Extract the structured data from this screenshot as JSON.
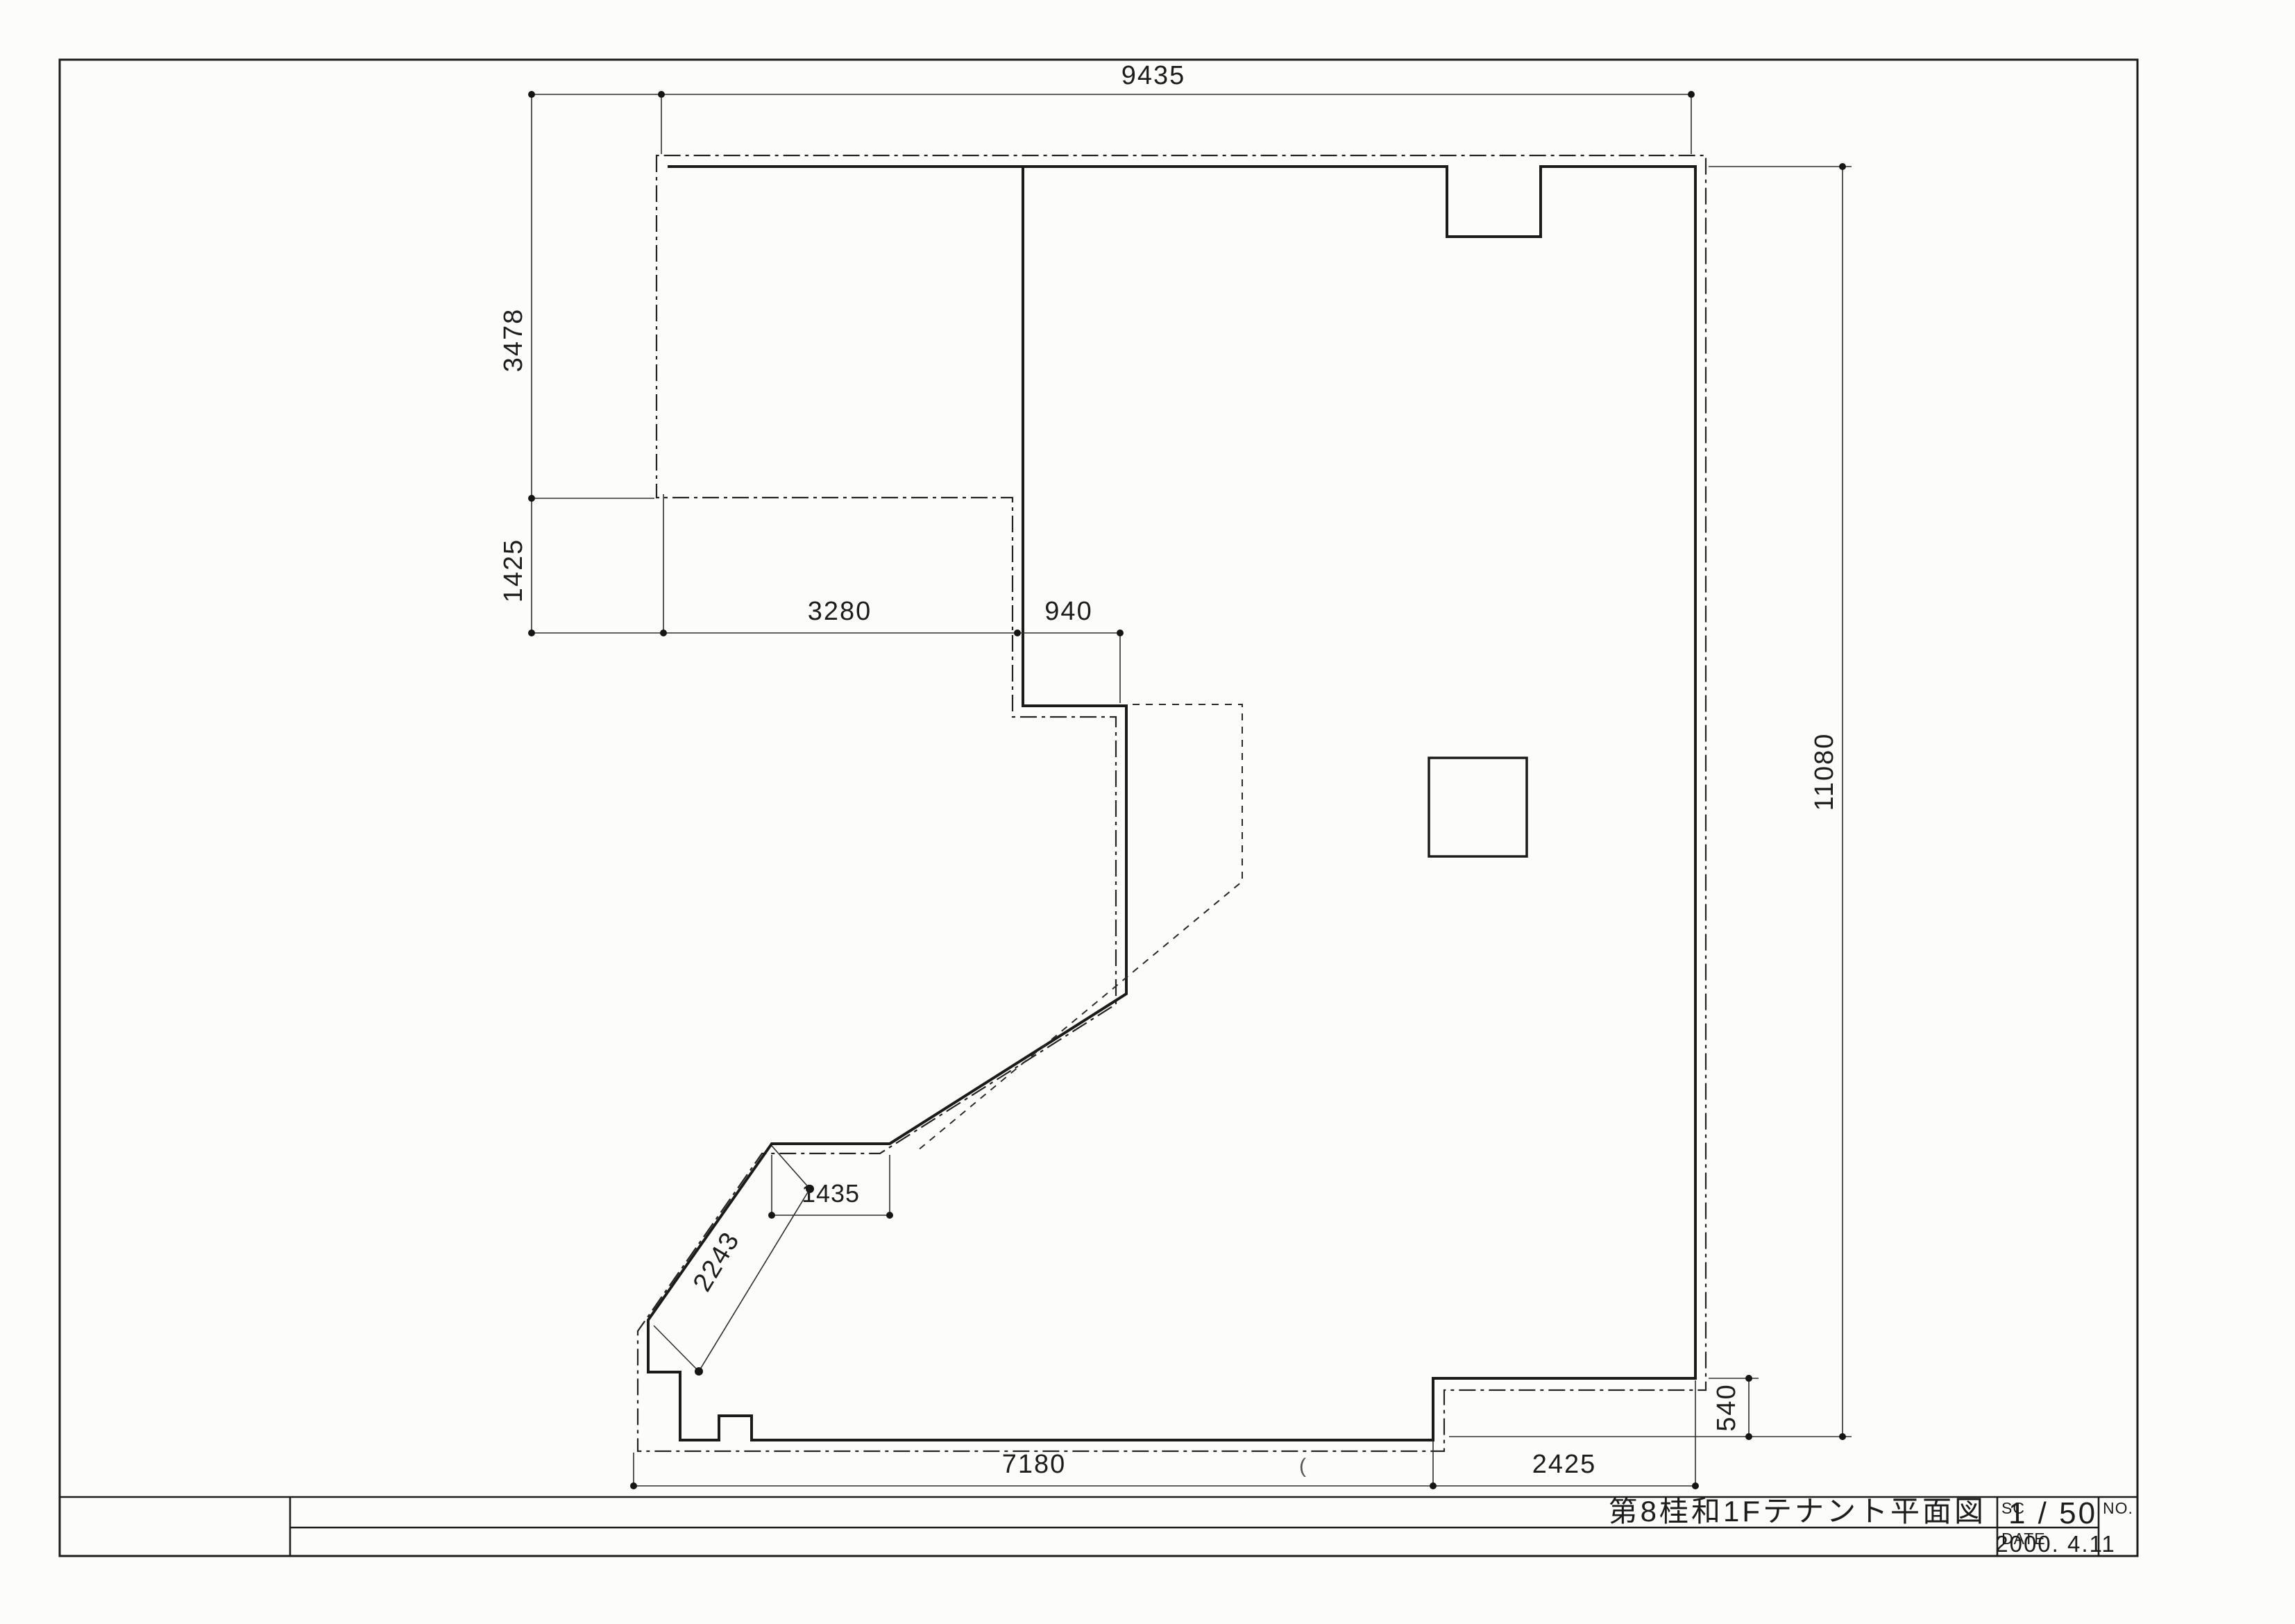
{
  "document": {
    "type": "architectural-floor-plan-scan",
    "paper_color": "#fcfcfa",
    "ink_color": "#1d1d1d"
  },
  "title_block": {
    "title": "第8桂和1Fテナント平面図",
    "sc_label": "SC",
    "sc_value": "1 / 50",
    "date_label": "DATE",
    "date_value": "2000. 4.11",
    "no_label": "NO."
  },
  "dimensions": {
    "top_width": "9435",
    "left_upper_height": "3478",
    "left_lower_height": "1425",
    "interior_width": "3280",
    "interior_offset": "940",
    "right_height": "11080",
    "right_step_height": "540",
    "bottom_width": "7180",
    "bottom_right_width": "2425",
    "diagonal_length": "2243",
    "diagonal_jog_width": "1435"
  },
  "artifacts": {
    "stray_mark": "("
  }
}
